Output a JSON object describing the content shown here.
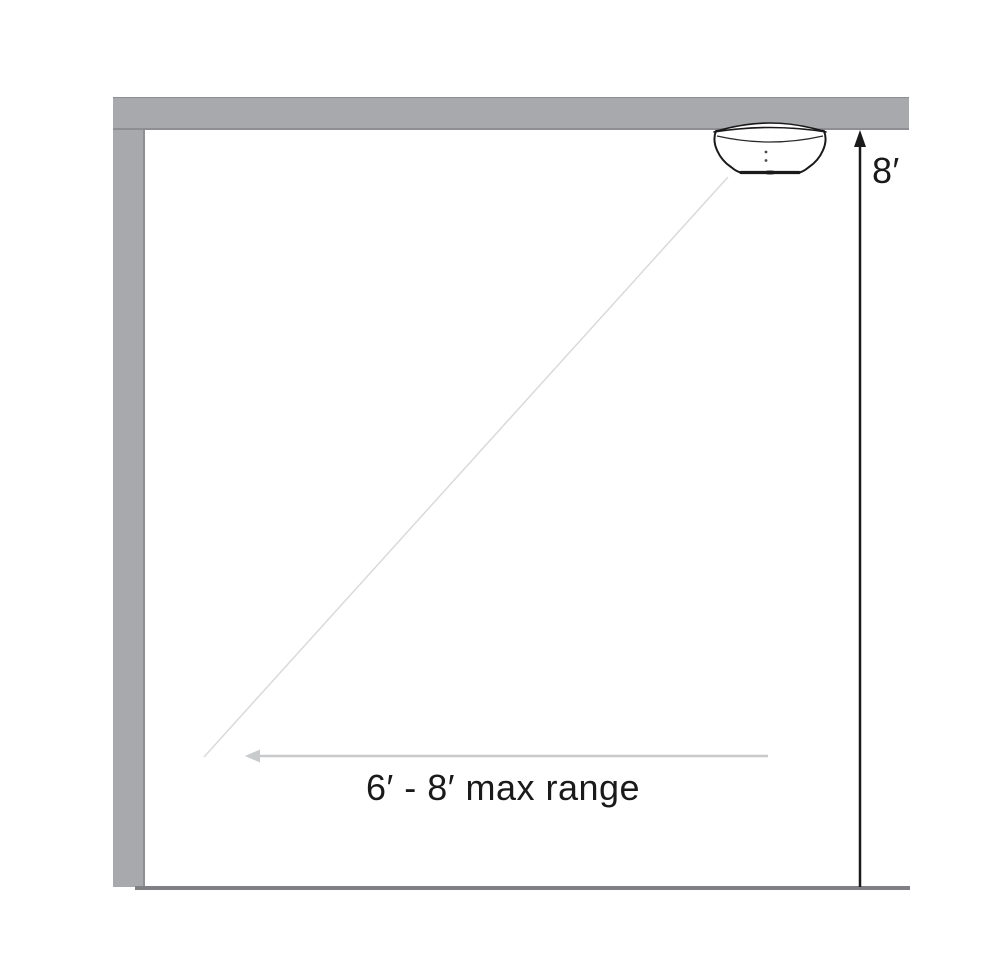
{
  "figure": {
    "labels": {
      "ceiling_height": "8′",
      "max_range": "6′ - 8′ max range"
    },
    "icons": {
      "device": "ceiling-mounted-motion-sensor",
      "beam": "detection-beam-line",
      "range_arrow": "left-arrow",
      "height_arrow": "up-arrow"
    },
    "colors": {
      "wall": "#a7a9ac",
      "wall_edge": "#8d8f92",
      "floor": "#7f8184",
      "beam": "#d9dadb",
      "range_arrow": "#c9cacc",
      "ink": "#1a1a1a"
    }
  }
}
